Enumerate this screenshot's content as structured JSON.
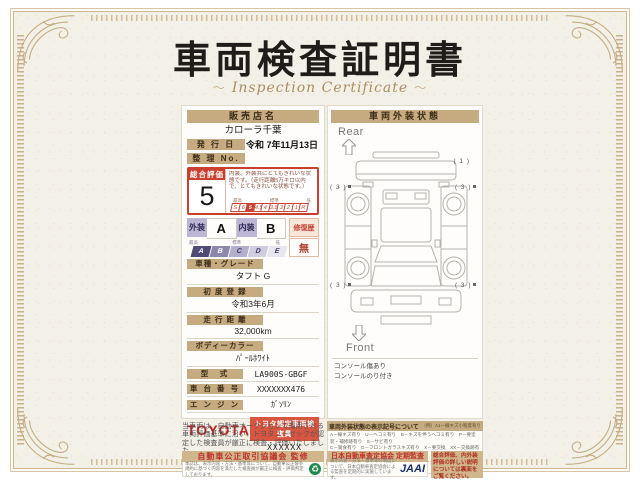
{
  "page": {
    "title": "車両検査証明書",
    "subtitle": "Inspection Certificate",
    "subtitle_ornament": "～"
  },
  "left": {
    "dealer_header": "販売店名",
    "dealer_name": "カローラ千葉",
    "issue_label": "発 行 日",
    "issue_value": "令和 7年11月13日",
    "refno_label": "整 理 No.",
    "refno_value": "",
    "rating": {
      "label": "総合評価",
      "score": "5",
      "description": "内装、外装共にとてもきれいな状態です。（走行距離5万キロ以内で、とてもきれいな状態です。）",
      "scale_high": "最高",
      "scale_mid": "標準",
      "scale_low": "低",
      "scale": [
        "S",
        "6",
        "5",
        "4.5",
        "4",
        "3.5",
        "3",
        "2",
        "1",
        "R"
      ],
      "selected": "5"
    },
    "grades": {
      "exterior_label": "外装",
      "exterior_value": "A",
      "interior_label": "内装",
      "interior_value": "B",
      "repair_label": "修復歴",
      "repair_value": "無",
      "scale_high": "最高",
      "scale_mid": "標準",
      "scale_low": "低",
      "scale": [
        "A",
        "B",
        "C",
        "D",
        "E"
      ]
    },
    "fields": [
      {
        "label": "車種・グレード",
        "value": "タフト G"
      },
      {
        "label": "初 度 登 録",
        "value": "令和3年6月"
      },
      {
        "label": "走 行 距 離",
        "value": "32,000km"
      },
      {
        "label": "ボディーカラー",
        "value": "ﾊﾟｰﾙﾎﾜｲﾄ"
      }
    ],
    "fields_inline": [
      {
        "label": "型　式",
        "value": "LA900S-GBGF"
      },
      {
        "label": "車 台 番 号",
        "value": "XXXXXXX476"
      },
      {
        "label": "エ ン ジ ン",
        "value": "ｶﾞｿﾘﾝ"
      }
    ],
    "toyota": {
      "logo": "TOYOTA",
      "badge": "トヨタ認定車両検査員",
      "inspector_id": "XXXXXX"
    }
  },
  "right": {
    "header": "車両外装状態",
    "rear_label": "Rear",
    "front_label": "Front",
    "markers": {
      "rear_right": "( 1 )",
      "mid_left": "( 3 )",
      "mid_right": "( 3 )",
      "front_left": "( 3 )",
      "front_right": "( 3 )"
    },
    "notes": [
      "コンソール傷あり",
      "コンソールのり付き"
    ]
  },
  "footer": {
    "statement": "当車両は、自動車オークションで運用される車両評価基準に沿い、トヨタユーゼックが認定した検査員が厳正に検査・評価いたしました。",
    "legend_title": "車両外装状態の表示記号について",
    "legend_example": "（例）A1ー線キズ小程度有り",
    "legend_lines": [
      "A－線キズ有り　U－ヘコミ有り　B－キズを伴うヘコミ有り　P－要塗装・補修跡有り　S－サビ有り",
      "C－腐食有り　G－フロントガラスキズ有り　X－要交換　XX－交換跡有り",
      "1－小程度　2－中程度　3－中程度以上　・マーク等の表記位置は図の通りとしています。"
    ],
    "org1": {
      "header": "自動車公正取引協議会 監修",
      "text": "本誌は、表示内容・方法・基準等について、自動車公正競争規約に基づく内容を満たした検査員が厳正に検査・評価判定しております。",
      "mark": "♻"
    },
    "org2": {
      "header": "日本自動車査定協会 定期監査",
      "text": "表示内容・方法・基準等の制度について、日本自動車査定協会による監査を定期的に実施しています。",
      "logo": "JAAI"
    },
    "org3": {
      "text": "総合評価、内外装評価の詳しい説明については裏面をご覧ください。"
    }
  },
  "colors": {
    "accent_red": "#c9402e",
    "tan": "#c5ab7f",
    "lavender": "#bcb6d4",
    "paper": "#f3f0e8",
    "jaai_navy": "#1d2f6b",
    "green_mark": "#1f8a4c"
  }
}
